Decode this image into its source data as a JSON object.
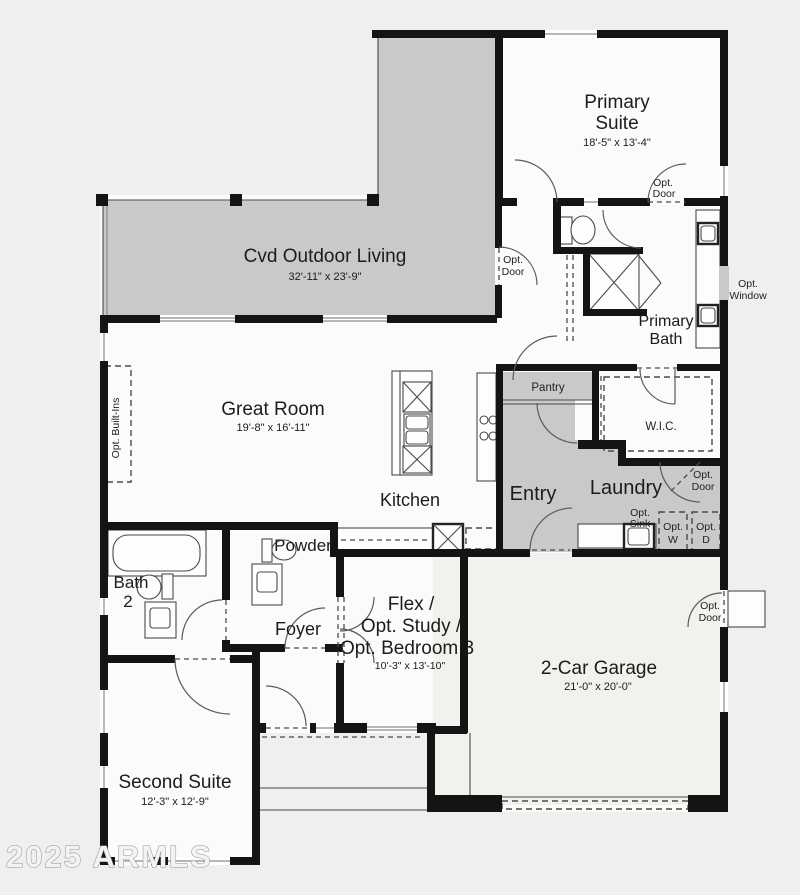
{
  "watermark": "2025 ARMLS",
  "colors": {
    "shaded": "#c9c9c9",
    "wall": "#141414",
    "background": "#f0efed",
    "interior": "#fbfbf9"
  },
  "rooms": {
    "primary_suite": {
      "line1": "Primary",
      "line2": "Suite",
      "dims": "18'-5\" x 13'-4\""
    },
    "cvd_outdoor_living": {
      "label": "Cvd Outdoor Living",
      "dims": "32'-11\" x 23'-9\""
    },
    "great_room": {
      "label": "Great Room",
      "dims": "19'-8\" x 16'-11\""
    },
    "primary_bath": {
      "line1": "Primary",
      "line2": "Bath"
    },
    "wic": {
      "label": "W.I.C."
    },
    "pantry": {
      "label": "Pantry"
    },
    "kitchen": {
      "label": "Kitchen"
    },
    "entry": {
      "label": "Entry"
    },
    "laundry": {
      "label": "Laundry"
    },
    "powder": {
      "label": "Powder"
    },
    "bath2": {
      "line1": "Bath",
      "line2": "2"
    },
    "foyer": {
      "label": "Foyer"
    },
    "flex": {
      "line1": "Flex /",
      "line2": "Opt. Study /",
      "line3": "Opt. Bedroom 3",
      "dims": "10'-3\" x 13'-10\""
    },
    "garage": {
      "label": "2-Car Garage",
      "dims": "21'-0\" x 20'-0\""
    },
    "second_suite": {
      "label": "Second Suite",
      "dims": "12'-3\" x 12'-9\""
    }
  },
  "annotations": {
    "opt_door": {
      "line1": "Opt.",
      "line2": "Door"
    },
    "opt_window": {
      "line1": "Opt.",
      "line2": "Window"
    },
    "opt_sink": {
      "line1": "Opt.",
      "line2": "Sink"
    },
    "opt_washer": {
      "line1": "Opt.",
      "line2": "W"
    },
    "opt_dryer": {
      "line1": "Opt.",
      "line2": "D"
    },
    "opt_built_ins": {
      "label": "Opt. Built-Ins"
    }
  }
}
